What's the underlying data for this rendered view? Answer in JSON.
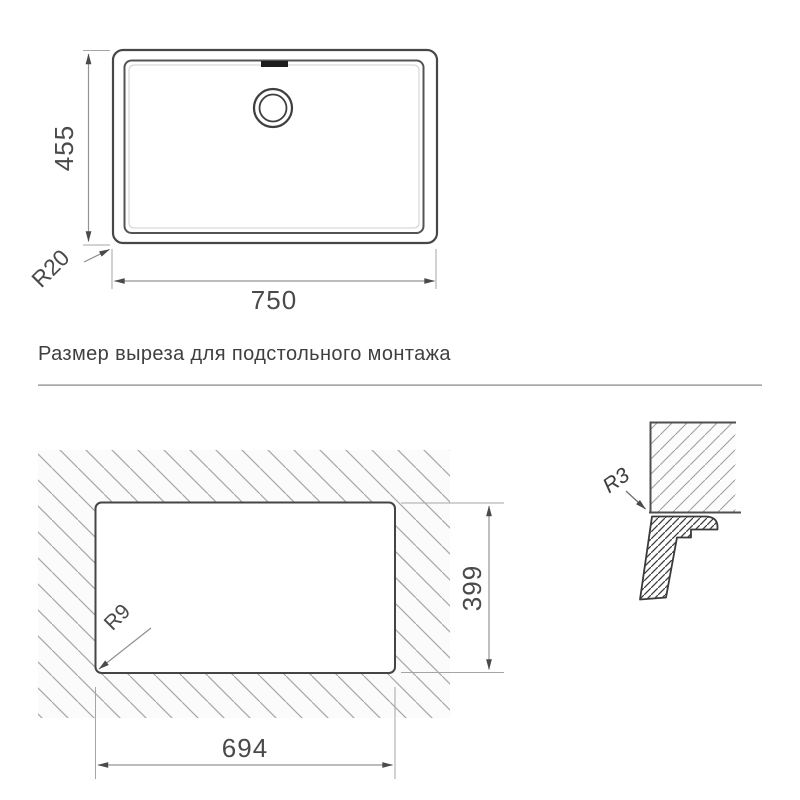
{
  "title": {
    "text": "Размер выреза для подстольного монтажа"
  },
  "top_view": {
    "width_label": "750",
    "height_label": "455",
    "corner_radius_label": "R20"
  },
  "cutout_view": {
    "width_label": "694",
    "height_label": "399",
    "corner_radius_label": "R9"
  },
  "edge_detail": {
    "radius_label": "R3"
  },
  "colors": {
    "background": "#ffffff",
    "drawing_line": "#474747",
    "dimension_line": "#949494",
    "extension_line": "#a5a5a5",
    "hatch_light": "#a6a6a6",
    "hatch_dark": "#3d3d3d",
    "text": "#4a4a4a",
    "separator": "#b3b3b3"
  }
}
